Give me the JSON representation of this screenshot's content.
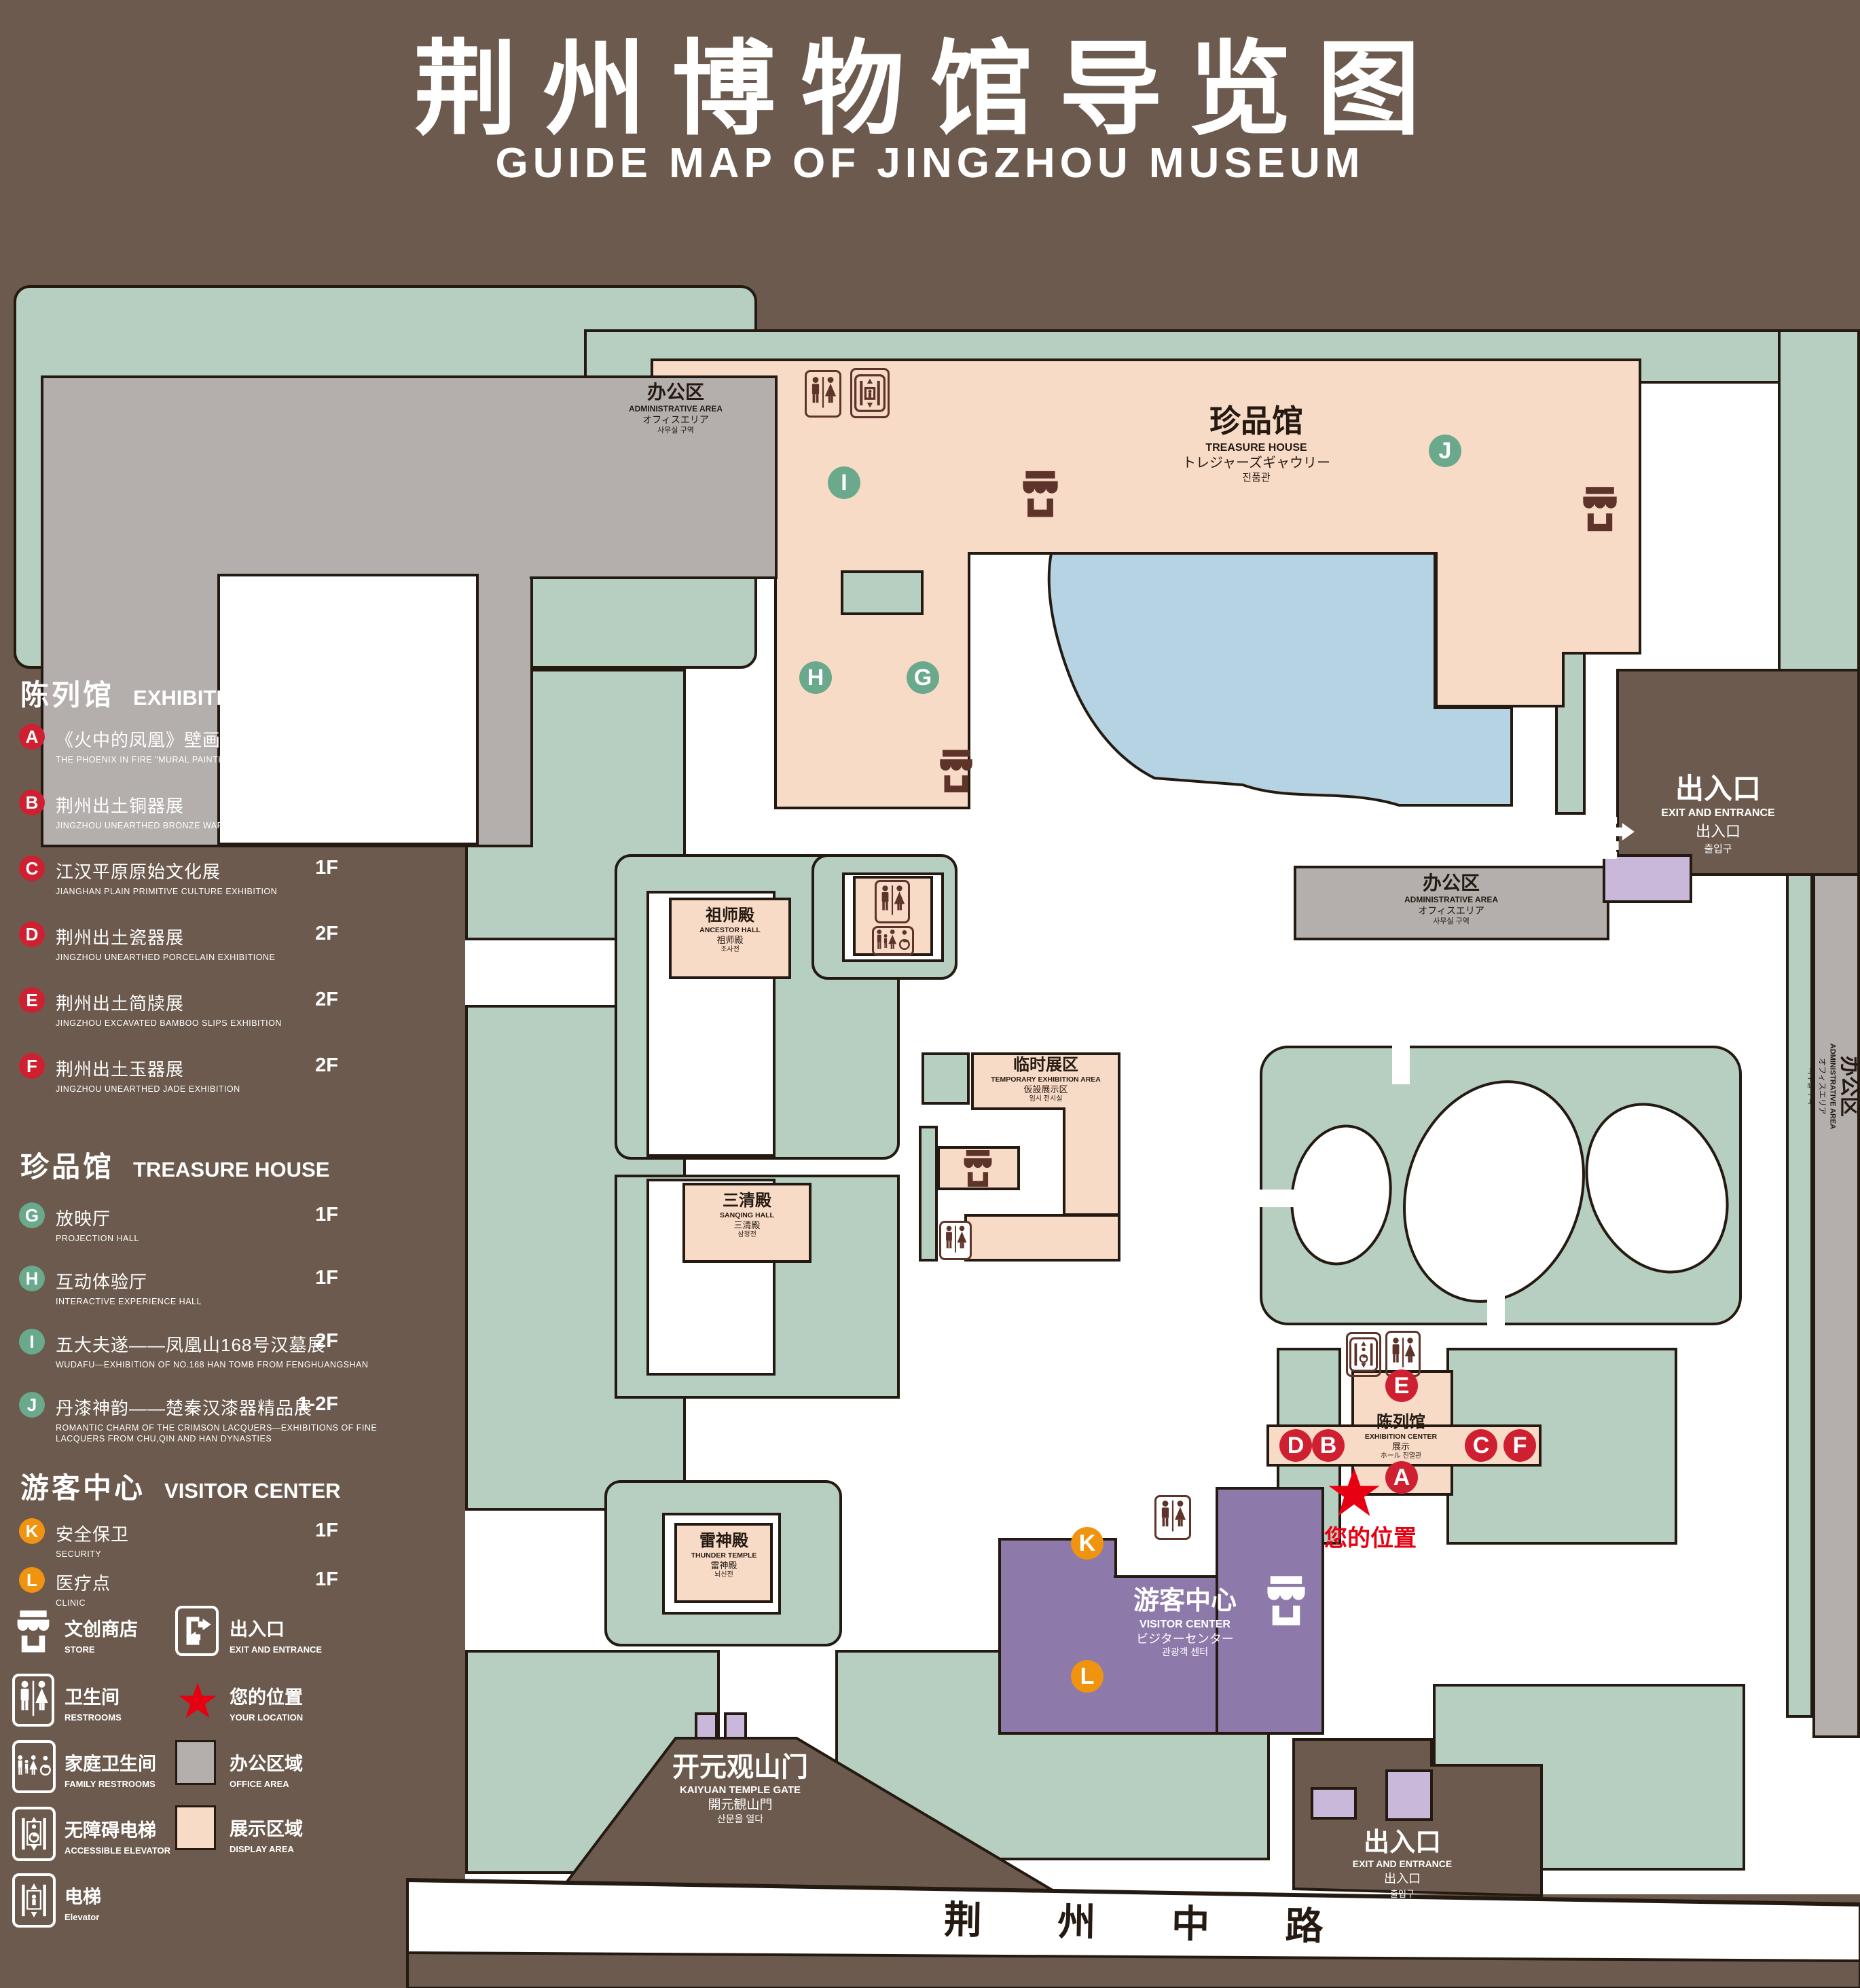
{
  "title": {
    "zh": "荆州博物馆导览图",
    "en": "GUIDE MAP OF JINGZHOU MUSEUM"
  },
  "colors": {
    "background_brown": "#6b5a4d",
    "lawn_green": "#b6cfc1",
    "display_pink": "#f8dbc7",
    "office_gray": "#b4afac",
    "lake_blue": "#b5d3e2",
    "visitor_purple": "#8d7aab",
    "entrance_purple": "#c9b8d9",
    "marker_red": "#cf2031",
    "marker_green": "#6aa98b",
    "marker_orange": "#f0930f",
    "location_red": "#e60012",
    "icon_maroon": "#5e342a",
    "outline": "#241a12"
  },
  "legend": {
    "sections": [
      {
        "zh": "陈列馆",
        "en": "EXHIBITION CENTER",
        "items": [
          {
            "code": "A",
            "zh": "《火中的凤凰》壁画",
            "en": "THE PHOENIX IN FIRE \"MURAL PAINTING",
            "floor": "1F"
          },
          {
            "code": "B",
            "zh": "荆州出土铜器展",
            "en": "JINGZHOU UNEARTHED BRONZE WARE EXHIBITION",
            "floor": "1F"
          },
          {
            "code": "C",
            "zh": "江汉平原原始文化展",
            "en": "JIANGHAN PLAIN PRIMITIVE CULTURE EXHIBITION",
            "floor": "1F"
          },
          {
            "code": "D",
            "zh": "荆州出土瓷器展",
            "en": "JINGZHOU UNEARTHED PORCELAIN EXHIBITIONE",
            "floor": "2F"
          },
          {
            "code": "E",
            "zh": "荆州出土简牍展",
            "en": "JINGZHOU EXCAVATED BAMBOO SLIPS EXHIBITION",
            "floor": "2F"
          },
          {
            "code": "F",
            "zh": "荆州出土玉器展",
            "en": "JINGZHOU UNEARTHED JADE EXHIBITION",
            "floor": "2F"
          }
        ]
      },
      {
        "zh": "珍品馆",
        "en": "TREASURE HOUSE",
        "items": [
          {
            "code": "G",
            "zh": "放映厅",
            "en": "PROJECTION HALL",
            "floor": "1F"
          },
          {
            "code": "H",
            "zh": "互动体验厅",
            "en": "INTERACTIVE EXPERIENCE HALL",
            "floor": "1F"
          },
          {
            "code": "I",
            "zh": "五大夫遂——凤凰山168号汉墓展",
            "en": "WUDAFU—EXHIBITION OF NO.168 HAN TOMB FROM FENGHUANGSHAN",
            "floor": "2F"
          },
          {
            "code": "J",
            "zh": "丹漆神韵——楚秦汉漆器精品展",
            "en": "ROMANTIC CHARM OF THE CRIMSON LACQUERS—EXHIBITIONS OF FINE LACQUERS FROM CHU,QIN AND HAN DYNASTIES",
            "floor": "1-2F"
          }
        ]
      },
      {
        "zh": "游客中心",
        "en": "VISITOR CENTER",
        "items": [
          {
            "code": "K",
            "zh": "安全保卫",
            "en": "SECURITY",
            "floor": "1F"
          },
          {
            "code": "L",
            "zh": "医疗点",
            "en": "CLINIC",
            "floor": "1F"
          }
        ]
      }
    ],
    "key": {
      "store": {
        "zh": "文创商店",
        "en": "STORE"
      },
      "restrooms": {
        "zh": "卫生间",
        "en": "RESTROOMS"
      },
      "family_restrooms": {
        "zh": "家庭卫生间",
        "en": "FAMILY RESTROOMS"
      },
      "accessible_elevator": {
        "zh": "无障碍电梯",
        "en": "ACCESSIBLE ELEVATOR"
      },
      "elevator": {
        "zh": "电梯",
        "en": "Elevator"
      },
      "exit": {
        "zh": "出入口",
        "en": "EXIT AND ENTRANCE"
      },
      "your_location": {
        "zh": "您的位置",
        "en": "YOUR LOCATION"
      },
      "office_area": {
        "zh": "办公区域",
        "en": "OFFICE AREA"
      },
      "display_area": {
        "zh": "展示区域",
        "en": "DISPLAY AREA"
      }
    }
  },
  "map": {
    "buildings": {
      "admin_top_left": {
        "lines": [
          "办公区",
          "ADMINISTRATIVE AREA",
          "オフィスエリア",
          "사무실 구역"
        ]
      },
      "admin_right": {
        "lines": [
          "办公区",
          "ADMINISTRATIVE AREA",
          "オフィスエリア",
          "사무실 구역"
        ]
      },
      "admin_far_right": {
        "lines": [
          "办公区",
          "ADMINISTRATIVE AREA",
          "オフィスエリア",
          "사무실 구역"
        ]
      },
      "treasure_house": {
        "lines": [
          "珍品馆",
          "TREASURE HOUSE",
          "トレジャーズギャウリー",
          "진품관"
        ]
      },
      "ancestor_hall": {
        "lines": [
          "祖师殿",
          "ANCESTOR HALL",
          "祖师殿",
          "조사전"
        ]
      },
      "sanqing_hall": {
        "lines": [
          "三清殿",
          "SANQING HALL",
          "三清殿",
          "삼청전"
        ]
      },
      "thunder_temple": {
        "lines": [
          "雷神殿",
          "THUNDER TEMPLE",
          "雷神殿",
          "뇌신전"
        ]
      },
      "temporary_exhibition": {
        "lines": [
          "临时展区",
          "TEMPORARY EXHIBITION AREA",
          "仮設展示区",
          "임시 전시실"
        ]
      },
      "exhibition_center": {
        "lines": [
          "陈列馆",
          "EXHIBITION CENTER",
          "展示",
          "ホール 진열관"
        ]
      },
      "visitor_center": {
        "lines": [
          "游客中心",
          "VISITOR CENTER",
          "ビジターセンター",
          "관광객 센터"
        ]
      },
      "kaiyuan_gate": {
        "lines": [
          "开元观山门",
          "KAIYUAN TEMPLE GATE",
          "開元観山門",
          "산문을 열다"
        ]
      }
    },
    "exits": {
      "top_right": {
        "lines": [
          "出入口",
          "EXIT AND ENTRANCE",
          "出入口",
          "출입구"
        ]
      },
      "bottom_right": {
        "lines": [
          "出入口",
          "EXIT AND ENTRANCE",
          "出入口",
          "출입구"
        ]
      }
    },
    "street": {
      "name": "荆 州 中 路"
    },
    "your_location_label": "您的位置",
    "markers": [
      {
        "letter": "A"
      },
      {
        "letter": "B"
      },
      {
        "letter": "C"
      },
      {
        "letter": "D"
      },
      {
        "letter": "E"
      },
      {
        "letter": "F"
      },
      {
        "letter": "G"
      },
      {
        "letter": "H"
      },
      {
        "letter": "I"
      },
      {
        "letter": "J"
      },
      {
        "letter": "K"
      },
      {
        "letter": "L"
      }
    ]
  }
}
